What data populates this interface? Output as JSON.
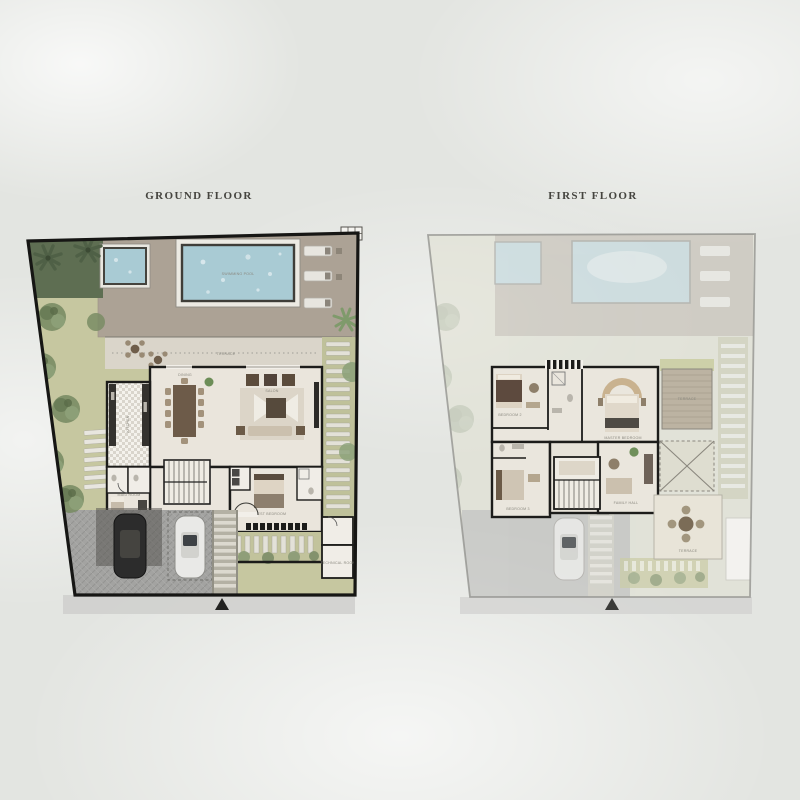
{
  "page": {
    "background_color": "#e3e5e1",
    "description": "Villa floor plan brochure page with two site plans side by side"
  },
  "ground_floor": {
    "title": "GROUND FLOOR",
    "labels": {
      "pool": "SWIMMING POOL",
      "terrace": "TERRACE",
      "kitchen": "KITCHEN",
      "dining": "DINING",
      "salon": "SALON",
      "guest_bedroom": "GUEST BEDROOM",
      "maid_room": "MAID ROOM",
      "technical": "TECHNICAL ROOM"
    }
  },
  "first_floor": {
    "title": "FIRST FLOOR",
    "labels": {
      "bedroom_2": "BEDROOM 2",
      "master_bedroom": "MASTER BEDROOM",
      "bedroom_3": "BEDROOM 3",
      "family_hall": "FAMILY HALL",
      "terrace_upper": "TERRACE",
      "terrace_lower": "TERRACE"
    }
  },
  "colors": {
    "pool_water": "#a9cbd4",
    "lawn": "#c6c7a0",
    "deck": "#aca295",
    "interior_floor": "#eae5dc",
    "wall": "#1c1c1a",
    "title_text": "#45443f",
    "driveway": "#a3a3a1"
  }
}
